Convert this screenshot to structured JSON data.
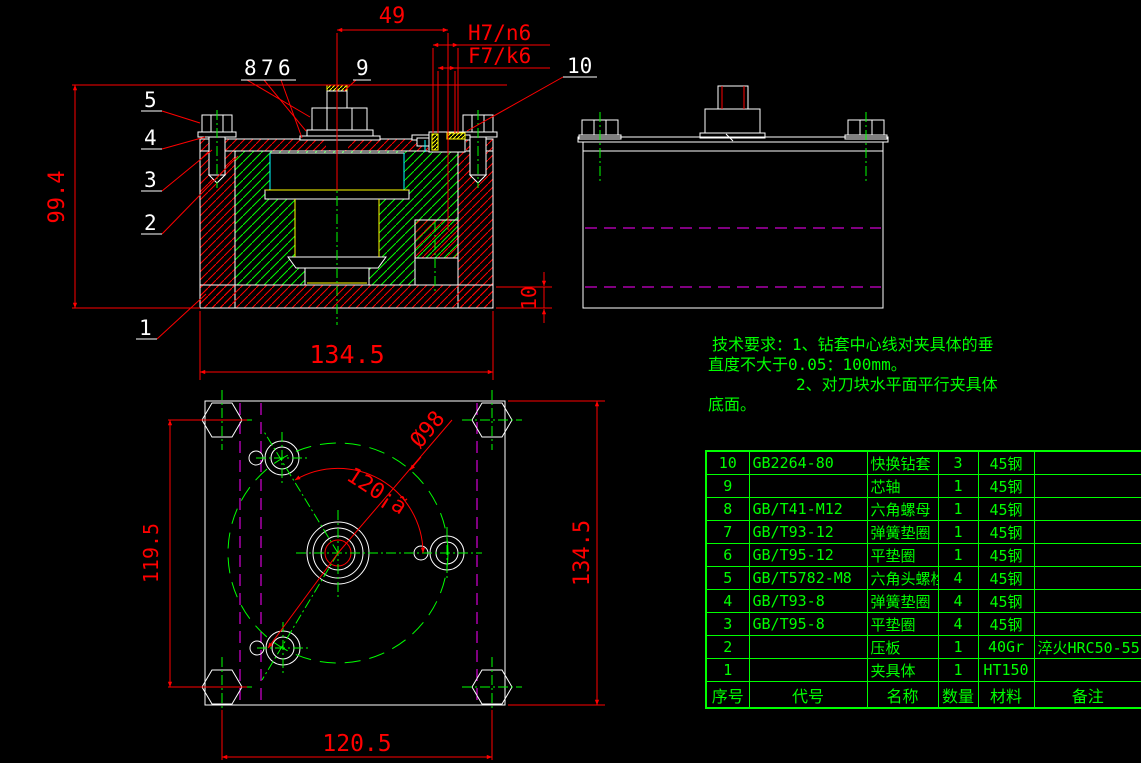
{
  "colors": {
    "background": "#000000",
    "outline_white": "#ffffff",
    "dimension_red": "#ff0000",
    "annotation_green": "#00ff00",
    "hidden_magenta": "#ff00ff",
    "accent_yellow": "#ffff00",
    "accent_cyan": "#00ffff"
  },
  "dims": {
    "d49": "49",
    "h7n6": "H7/n6",
    "f7k6": "F7/k6",
    "d99_4": "99.4",
    "sec_134_5": "134.5",
    "d10": "10",
    "plan_119_5": "119.5",
    "plan_134_5": "134.5",
    "plan_120_5": "120.5",
    "dia98": "Ø98",
    "ang120": "120¡ã"
  },
  "part_labels": {
    "n1": "1",
    "n2": "2",
    "n3": "3",
    "n4": "4",
    "n5": "5",
    "n6": "6",
    "n7": "7",
    "n8": "8",
    "n9": "9",
    "n10": "10"
  },
  "tech_req": {
    "line1": "技术要求：1、钻套中心线对夹具体的垂",
    "line2": "直度不大于0.05：100mm。",
    "line3": "2、对刀块水平面平行夹具体",
    "line4": "底面。"
  },
  "bom": {
    "rows": [
      {
        "seq": "10",
        "code": "GB2264-80",
        "name": "快换钻套",
        "qty": "3",
        "material": "45钢",
        "remark": ""
      },
      {
        "seq": "9",
        "code": "",
        "name": "芯轴",
        "qty": "1",
        "material": "45钢",
        "remark": ""
      },
      {
        "seq": "8",
        "code": "GB/T41-M12",
        "name": "六角螺母",
        "qty": "1",
        "material": "45钢",
        "remark": ""
      },
      {
        "seq": "7",
        "code": "GB/T93-12",
        "name": "弹簧垫圈",
        "qty": "1",
        "material": "45钢",
        "remark": ""
      },
      {
        "seq": "6",
        "code": "GB/T95-12",
        "name": "平垫圈",
        "qty": "1",
        "material": "45钢",
        "remark": ""
      },
      {
        "seq": "5",
        "code": "GB/T5782-M8",
        "name": "六角头螺栓",
        "qty": "4",
        "material": "45钢",
        "remark": ""
      },
      {
        "seq": "4",
        "code": "GB/T93-8",
        "name": "弹簧垫圈",
        "qty": "4",
        "material": "45钢",
        "remark": ""
      },
      {
        "seq": "3",
        "code": "GB/T95-8",
        "name": "平垫圈",
        "qty": "4",
        "material": "45钢",
        "remark": ""
      },
      {
        "seq": "2",
        "code": "",
        "name": "压板",
        "qty": "1",
        "material": "40Gr",
        "remark": "淬火HRC50-55"
      },
      {
        "seq": "1",
        "code": "",
        "name": "夹具体",
        "qty": "1",
        "material": "HT150",
        "remark": ""
      },
      {
        "seq": "序号",
        "code": "代号",
        "name": "名称",
        "qty": "数量",
        "material": "材料",
        "remark": "备注"
      }
    ]
  }
}
